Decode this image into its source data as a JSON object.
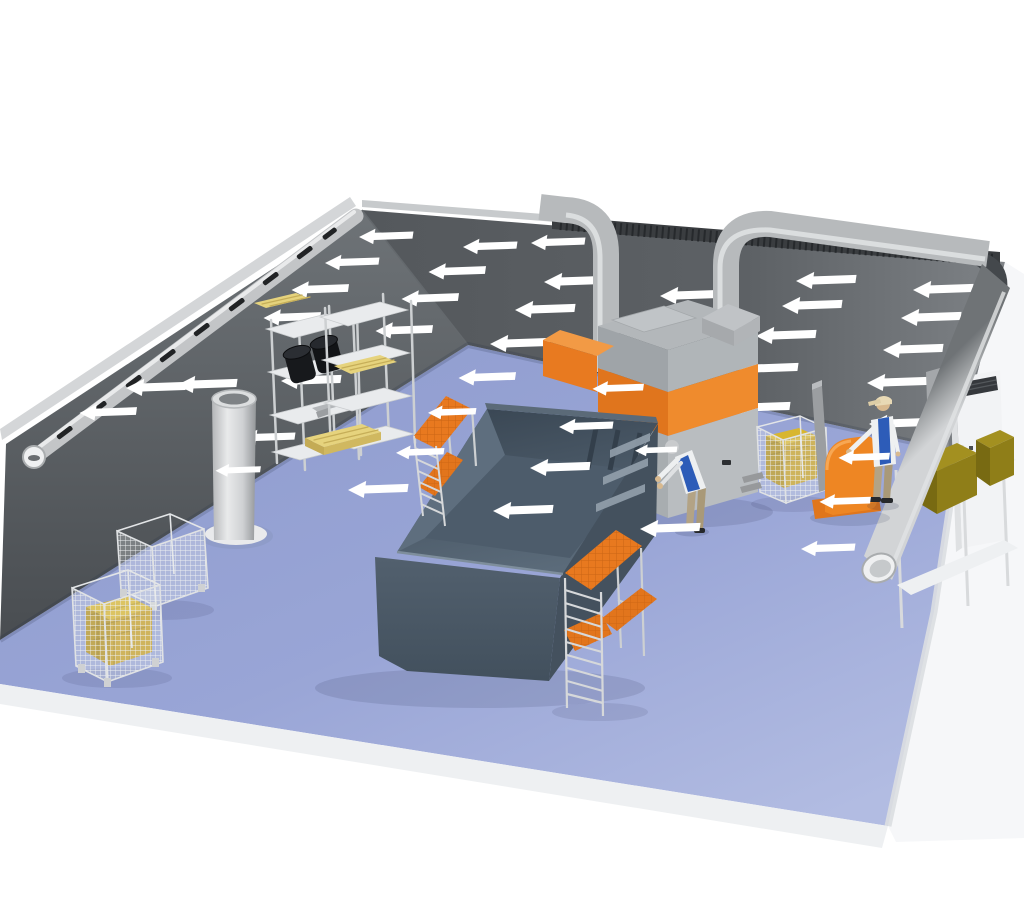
{
  "palette": {
    "background": "#ffffff",
    "floor": "#94a1d3",
    "floor_light": "#aeb8e0",
    "wall_dark": "#53575b",
    "wall_light": "#7b8084",
    "right_wall": "#f6f7f9",
    "accent_orange": "#e8791f",
    "orange_bright": "#ef8b2d",
    "tank_slate": "#4b5967",
    "tank_inner": "#5c6b7a",
    "arrow": "#ffffff",
    "duct_silver": "#c3c5c7",
    "duct_dark": "#3a3d40",
    "gold_crate": "#c8a41f",
    "olive_box": "#8d7c18",
    "vest_blue": "#2d5cb8",
    "pants_khaki": "#b3a385",
    "pallet_yellow": "#e6d37d",
    "shelf_white": "#e9ebed",
    "ladder_silver": "#cdd0d2"
  },
  "airflow": {
    "direction": "left",
    "arrow_color": "#ffffff",
    "wall_arrows": [
      {
        "x": 386,
        "y": 236,
        "s": 0.9
      },
      {
        "x": 490,
        "y": 246,
        "s": 0.9
      },
      {
        "x": 558,
        "y": 242,
        "s": 0.9
      },
      {
        "x": 352,
        "y": 262,
        "s": 0.9
      },
      {
        "x": 457,
        "y": 271,
        "s": 0.95
      },
      {
        "x": 574,
        "y": 281,
        "s": 1
      },
      {
        "x": 690,
        "y": 295,
        "s": 1
      },
      {
        "x": 826,
        "y": 280,
        "s": 1
      },
      {
        "x": 943,
        "y": 289,
        "s": 1
      },
      {
        "x": 320,
        "y": 289,
        "s": 0.95
      },
      {
        "x": 292,
        "y": 317,
        "s": 0.95
      },
      {
        "x": 430,
        "y": 298,
        "s": 0.95
      },
      {
        "x": 545,
        "y": 309,
        "s": 1
      },
      {
        "x": 812,
        "y": 305,
        "s": 1
      },
      {
        "x": 931,
        "y": 317,
        "s": 1
      },
      {
        "x": 404,
        "y": 330,
        "s": 0.95
      },
      {
        "x": 520,
        "y": 343,
        "s": 1
      },
      {
        "x": 786,
        "y": 335,
        "s": 1
      },
      {
        "x": 913,
        "y": 349,
        "s": 1
      },
      {
        "x": 768,
        "y": 368,
        "s": 1
      },
      {
        "x": 897,
        "y": 382,
        "s": 1
      },
      {
        "x": 760,
        "y": 407,
        "s": 1
      },
      {
        "x": 899,
        "y": 423,
        "s": 1
      },
      {
        "x": 487,
        "y": 377,
        "s": 0.95
      },
      {
        "x": 207,
        "y": 384,
        "s": 1
      },
      {
        "x": 311,
        "y": 380,
        "s": 1
      },
      {
        "x": 156,
        "y": 387,
        "s": 1
      },
      {
        "x": 108,
        "y": 412,
        "s": 0.95
      },
      {
        "x": 268,
        "y": 437,
        "s": 0.9
      }
    ],
    "front_arrows": [
      {
        "x": 238,
        "y": 470,
        "s": 0.75
      },
      {
        "x": 618,
        "y": 388,
        "s": 0.85
      },
      {
        "x": 864,
        "y": 457,
        "s": 0.85
      },
      {
        "x": 845,
        "y": 501,
        "s": 0.85
      },
      {
        "x": 586,
        "y": 426,
        "s": 0.9
      },
      {
        "x": 560,
        "y": 467,
        "s": 1
      },
      {
        "x": 523,
        "y": 510,
        "s": 1
      },
      {
        "x": 656,
        "y": 450,
        "s": 0.7
      },
      {
        "x": 452,
        "y": 412,
        "s": 0.8
      },
      {
        "x": 420,
        "y": 452,
        "s": 0.8
      },
      {
        "x": 378,
        "y": 489,
        "s": 1
      },
      {
        "x": 670,
        "y": 528,
        "s": 1
      },
      {
        "x": 828,
        "y": 548,
        "s": 0.9
      }
    ]
  },
  "objects": [
    {
      "name": "dip-tank"
    },
    {
      "name": "work-platform-left"
    },
    {
      "name": "work-platform-right"
    },
    {
      "name": "dust-collector-unit"
    },
    {
      "name": "extraction-duct-left"
    },
    {
      "name": "extraction-duct-right"
    },
    {
      "name": "wall-intake-duct"
    },
    {
      "name": "roof-ribbed-duct"
    },
    {
      "name": "main-exhaust-pipe"
    },
    {
      "name": "storage-rack-1"
    },
    {
      "name": "storage-rack-2"
    },
    {
      "name": "black-drums"
    },
    {
      "name": "cylindrical-silo"
    },
    {
      "name": "mesh-pallet-cage-empty"
    },
    {
      "name": "mesh-pallet-cage-gold-crate"
    },
    {
      "name": "mesh-pallet-cage-center"
    },
    {
      "name": "packing-machine"
    },
    {
      "name": "white-control-cabinet"
    },
    {
      "name": "right-storage-shelf"
    },
    {
      "name": "olive-boxes"
    },
    {
      "name": "wooden-pallets"
    },
    {
      "name": "worker-bending"
    },
    {
      "name": "worker-standing"
    }
  ],
  "counts": {
    "workers": 2,
    "airflow_arrows": 42
  }
}
